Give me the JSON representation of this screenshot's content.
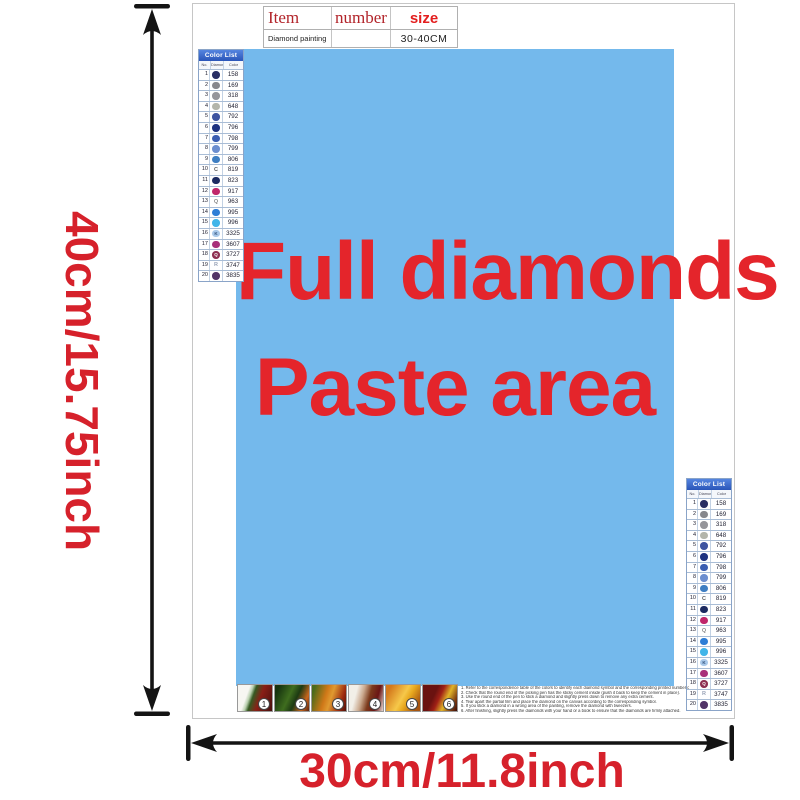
{
  "colors": {
    "paste_blue": "#74b9ec",
    "title_red": "#e4252b",
    "dimension_red": "#d6212b",
    "list_header_blue": "#3c6bd0",
    "arrow_black": "#141414"
  },
  "dimension_labels": {
    "height": "40cm/15.75inch",
    "width": "30cm/11.8inch"
  },
  "spec_table": {
    "col_item": "Item",
    "col_number": "number",
    "col_size": "size",
    "item_value": "Diamond painting",
    "number_value": "",
    "size_value": "30-40CM"
  },
  "paste_area": {
    "line1": "Full diamonds",
    "line2": "Paste area"
  },
  "color_list": {
    "title": "Color List",
    "col_no": "No.",
    "col_symbol": "Diamond",
    "col_color": "Color",
    "rows": [
      {
        "no": "1",
        "symbol": "",
        "style": "circle",
        "color": "#2a2e63",
        "symbol_color": "#ffffff",
        "code": "158"
      },
      {
        "no": "2",
        "symbol": "",
        "style": "circle",
        "color": "#87878b",
        "symbol_color": "#ffffff",
        "code": "169"
      },
      {
        "no": "3",
        "symbol": "",
        "style": "circle",
        "color": "#95959a",
        "symbol_color": "#ffffff",
        "code": "318"
      },
      {
        "no": "4",
        "symbol": "",
        "style": "circle",
        "color": "#b3b5aa",
        "symbol_color": "#555555",
        "code": "648"
      },
      {
        "no": "5",
        "symbol": "",
        "style": "circle",
        "color": "#3e54a1",
        "symbol_color": "#ffffff",
        "code": "792"
      },
      {
        "no": "6",
        "symbol": "",
        "style": "circle",
        "color": "#1e3280",
        "symbol_color": "#ffffff",
        "code": "796"
      },
      {
        "no": "7",
        "symbol": "",
        "style": "circle",
        "color": "#3a5db1",
        "symbol_color": "#ffffff",
        "code": "798"
      },
      {
        "no": "8",
        "symbol": "",
        "style": "circle",
        "color": "#6c8ecf",
        "symbol_color": "#ffffff",
        "code": "799"
      },
      {
        "no": "9",
        "symbol": "",
        "style": "circle",
        "color": "#3e7ec2",
        "symbol_color": "#ffffff",
        "code": "806"
      },
      {
        "no": "10",
        "symbol": "C",
        "style": "letter",
        "color": "#5a5a5a",
        "symbol_color": "#5a5a5a",
        "code": "819"
      },
      {
        "no": "11",
        "symbol": "",
        "style": "circle",
        "color": "#1c2a61",
        "symbol_color": "#ffffff",
        "code": "823"
      },
      {
        "no": "12",
        "symbol": "",
        "style": "circle",
        "color": "#c0266a",
        "symbol_color": "#ffffff",
        "code": "917"
      },
      {
        "no": "13",
        "symbol": "Q",
        "style": "letter",
        "color": "#8a8a8a",
        "symbol_color": "#8a8a8a",
        "code": "963"
      },
      {
        "no": "14",
        "symbol": "",
        "style": "circle",
        "color": "#2e7ed6",
        "symbol_color": "#ffffff",
        "code": "995"
      },
      {
        "no": "15",
        "symbol": "",
        "style": "circle",
        "color": "#41b5e9",
        "symbol_color": "#ffffff",
        "code": "996"
      },
      {
        "no": "16",
        "symbol": "K",
        "style": "circle",
        "color": "#a9c9ea",
        "symbol_color": "#33517a",
        "code": "3325"
      },
      {
        "no": "17",
        "symbol": "",
        "style": "circle",
        "color": "#a93079",
        "symbol_color": "#ffffff",
        "code": "3607"
      },
      {
        "no": "18",
        "symbol": "Q",
        "style": "circle",
        "color": "#8e3051",
        "symbol_color": "#ffffff",
        "code": "3727"
      },
      {
        "no": "19",
        "symbol": "R",
        "style": "letter",
        "color": "#9aa4b8",
        "symbol_color": "#9aa4b8",
        "code": "3747"
      },
      {
        "no": "20",
        "symbol": "",
        "style": "circle",
        "color": "#523467",
        "symbol_color": "#ffffff",
        "code": "3835"
      }
    ]
  },
  "steps": {
    "labels": [
      "1",
      "2",
      "3",
      "4",
      "5",
      "6"
    ]
  },
  "instructions": {
    "lines": [
      "1. Refer to the correspondence table of the colors to identify each diamond symbol and the corresponding printed number on the canvas.",
      "2. Check that the round end of the picking pen has the sticky cement inside (push it back to keep the cement in place).",
      "3. Use the round end of the pen to stick a diamond and slightly press down to remove any extra cement.",
      "4. Tear apart the partial film and place the diamond on the canvas according to the corresponding symbol.",
      "5. If you stick a diamond in a wrong area of the painting, remove the diamond with tweezers.",
      "6. After finishing, slightly press the diamonds with your hand or a book to ensure that the diamonds are firmly attached."
    ]
  }
}
